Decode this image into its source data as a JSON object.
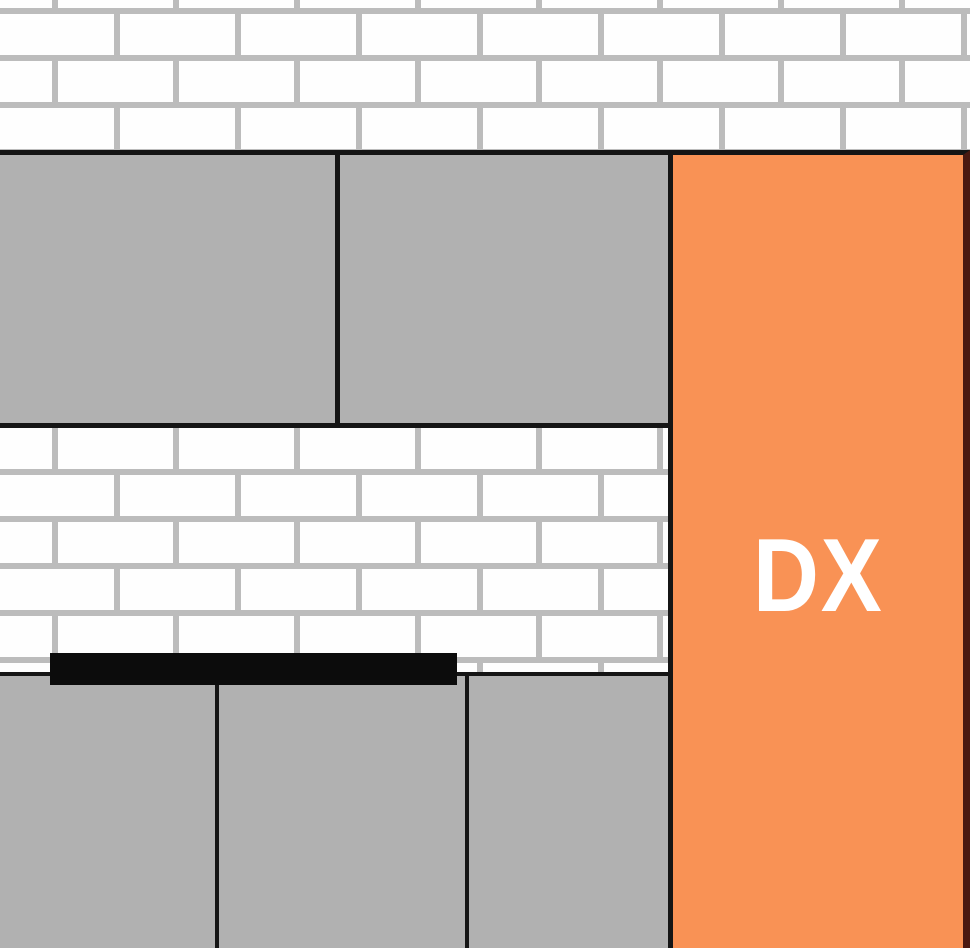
{
  "diagram": {
    "dx_label": "DX",
    "upper_panel_count": 2,
    "lower_panel_count": 3,
    "colors": {
      "brick_fill": "#FEFEFE",
      "mortar": "#BCBCBC",
      "panel_gray": "#B1B1B1",
      "outline_black": "#151515",
      "bar_black": "#0C0C0C",
      "dx_panel_orange": "#F99255",
      "dx_panel_edge": "#4A1911",
      "dx_text": "#FFFFFF"
    }
  }
}
